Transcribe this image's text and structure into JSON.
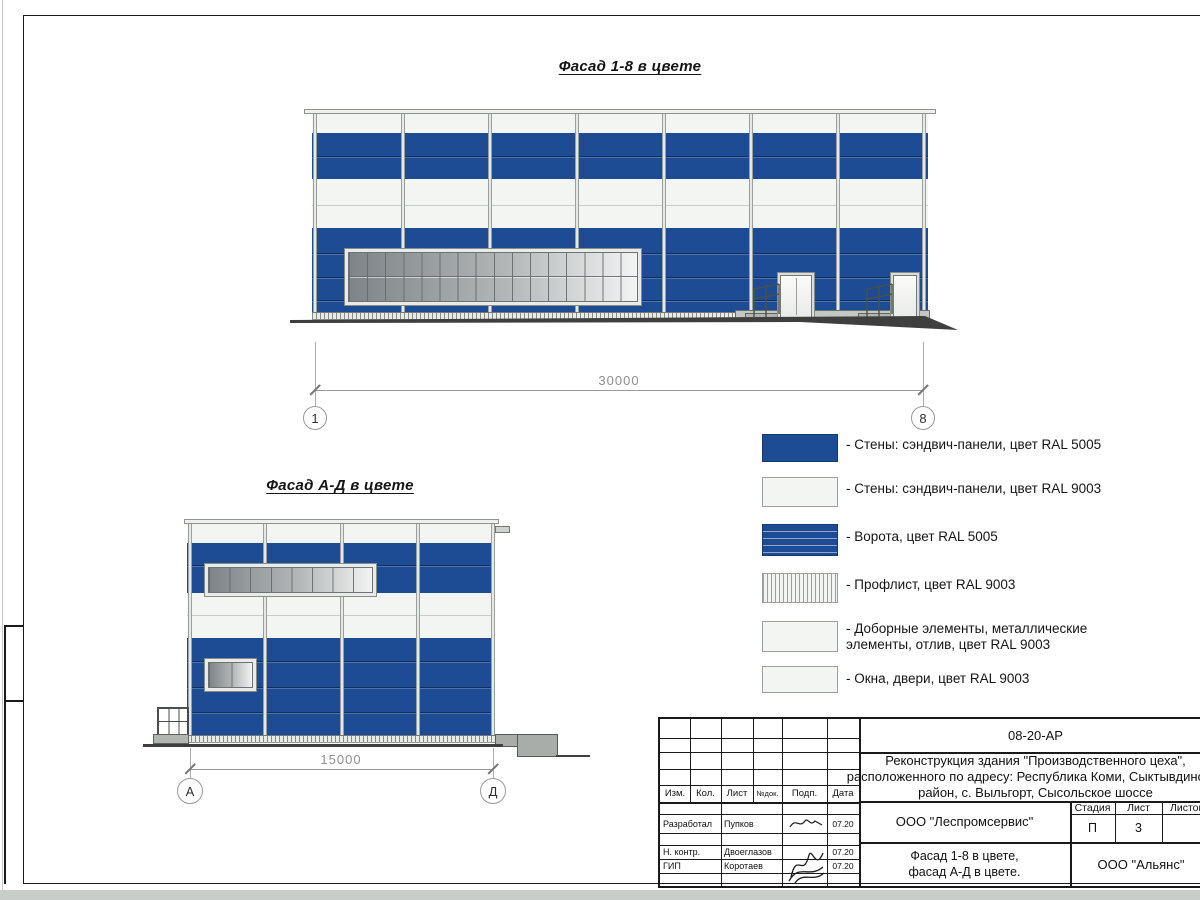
{
  "colors": {
    "ral5005": "#1e4c94",
    "ral9003": "#f3f5f2",
    "ground": "#3f3f3f"
  },
  "drawings": {
    "fasad18": {
      "title": "Фасад 1-8 в цвете",
      "dimension": "30000",
      "axis_left": "1",
      "axis_right": "8"
    },
    "fasadAD": {
      "title": "Фасад А-Д в цвете",
      "dimension": "15000",
      "axis_left": "А",
      "axis_right": "Д"
    }
  },
  "legend": {
    "items": [
      {
        "label": "- Стены: сэндвич-панели, цвет RAL 5005",
        "swatch": "ral5005-blue"
      },
      {
        "label": "- Стены: сэндвич-панели, цвет RAL 9003",
        "swatch": "ral9003-white"
      },
      {
        "label": "- Ворота, цвет RAL 5005",
        "swatch": "gate-blue-lines"
      },
      {
        "label": "- Профлист, цвет RAL 9003",
        "swatch": "proflist-hatch"
      },
      {
        "label": "- Доборные элементы, металлические элементы, отлив, цвет RAL 9003",
        "swatch": "ral9003-white"
      },
      {
        "label": "- Окна, двери, цвет RAL 9003",
        "swatch": "ral9003-white"
      }
    ]
  },
  "title_block": {
    "doc_code": "08-20-АР",
    "project_line1": "Реконструкция здания \"Производственного цеха\",",
    "project_line2": "расположенного по адресу: Республика Коми, Сыктывдинский",
    "project_line3": "район, с. Выльгорт, Сысольское шоссе",
    "col_izm": "Изм.",
    "col_kol": "Кол.",
    "col_list": "Лист",
    "col_ndoc": "№док.",
    "col_podp": "Подп.",
    "col_data": "Дата",
    "developer_role": "Разработал",
    "developer_name": "Пупков",
    "developer_date": "07.20",
    "ncontr_role": "Н. контр.",
    "ncontr_name": "Двоеглазов",
    "ncontr_date": "07.20",
    "gip_role": "ГИП",
    "gip_name": "Коротаев",
    "gip_date": "07.20",
    "org_design": "ООО \"Леспромсервис\"",
    "org_client": "ООО \"Альянс\"",
    "stage_label": "Стадия",
    "list_label": "Лист",
    "listov_label": "Листов",
    "stage_value": "П",
    "list_value": "3",
    "sheet_title_line1": "Фасад 1-8 в цвете,",
    "sheet_title_line2": "фасад А-Д в цвете."
  }
}
